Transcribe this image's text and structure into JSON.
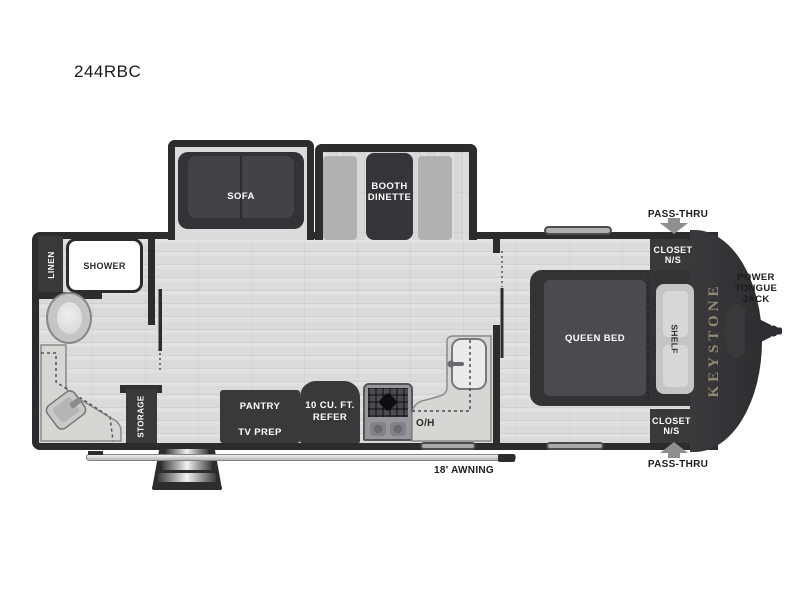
{
  "title": "244RBC",
  "brand": "KEYSTONE",
  "colors": {
    "wall": "#2c2b2d",
    "fixture_dark": "#39383b",
    "floor": "#dcdbdb",
    "bench": "#b3b1af",
    "counter": "#d8d6d3",
    "brand_text": "#938a6f",
    "callout_text": "#1c1c1e"
  },
  "slideouts": {
    "sofa": {
      "label": "SOFA"
    },
    "dinette": {
      "label": [
        "BOOTH",
        "DINETTE"
      ]
    }
  },
  "bathroom": {
    "linen": "LINEN",
    "shower": "SHOWER"
  },
  "kitchen": {
    "storage": "STORAGE",
    "pantry": [
      "PANTRY",
      "TV PREP"
    ],
    "refrigerator": [
      "10 CU. FT.",
      "REFER"
    ],
    "overhead": "O/H"
  },
  "bedroom": {
    "bed": "QUEEN BED",
    "shelf": "SHELF",
    "closet_roadside": [
      "CLOSET",
      "N/S"
    ],
    "closet_curbside": [
      "CLOSET",
      "N/S"
    ]
  },
  "exterior": {
    "pass_thru_roadside": "PASS-THRU",
    "pass_thru_curbside": "PASS-THRU",
    "power_tongue_jack": [
      "POWER",
      "TONGUE",
      "JACK"
    ],
    "awning": "18' AWNING"
  }
}
